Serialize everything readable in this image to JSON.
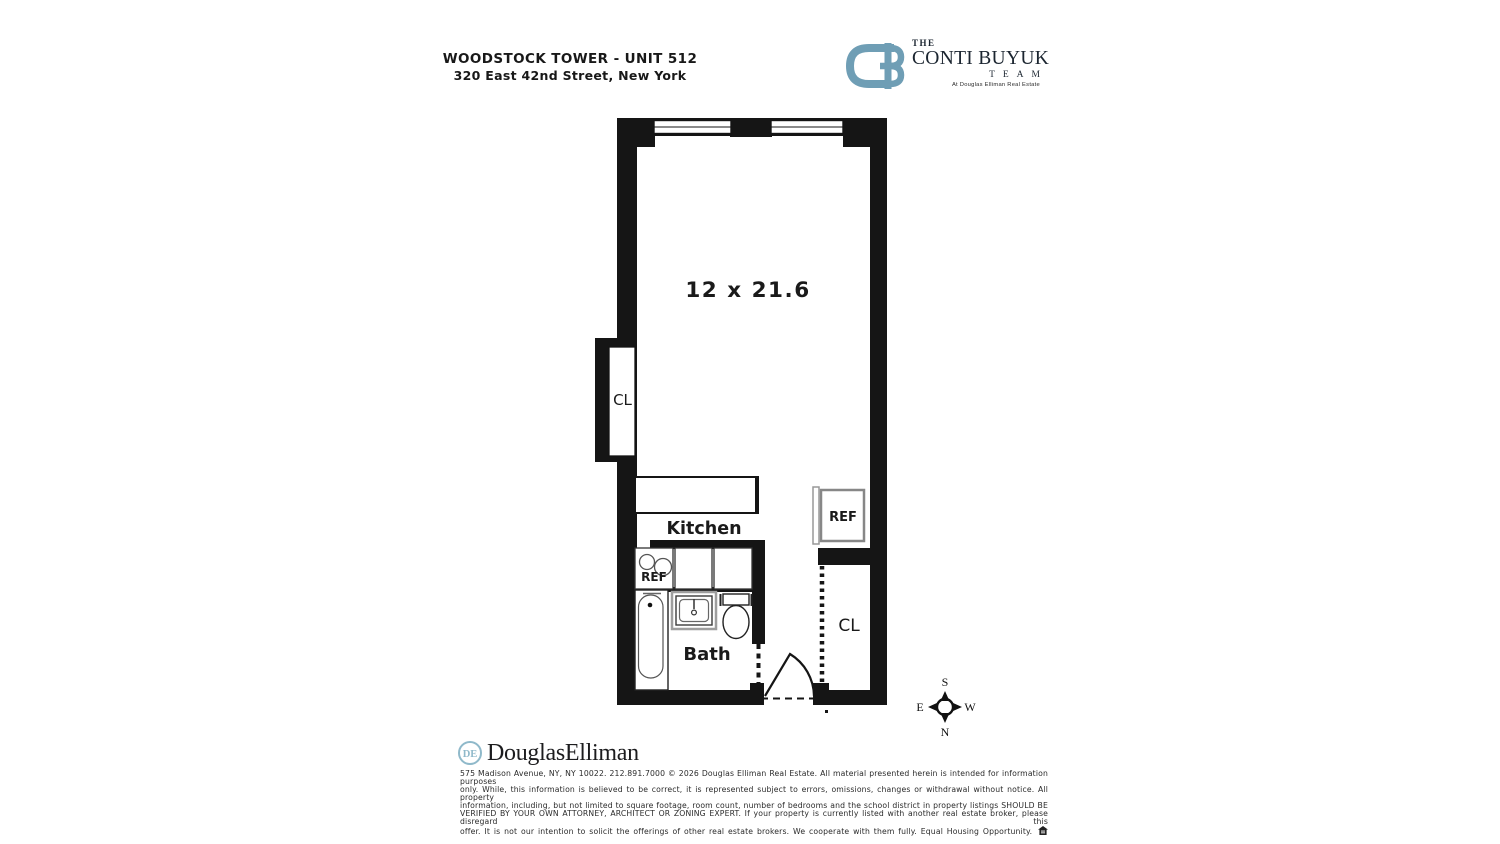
{
  "header": {
    "building": "WOODSTOCK TOWER - UNIT 512",
    "address": "320 East 42nd Street, New York"
  },
  "brand": {
    "monogram": "CB",
    "the": "THE",
    "name": "CONTI BUYUK",
    "team": "TEAM",
    "tagline": "At Douglas Elliman Real Estate",
    "accent_color": "#6f9eb5"
  },
  "floorplan": {
    "room_dimension": "12 x 21.6",
    "kitchen_label": "Kitchen",
    "bath_label": "Bath",
    "closet_left_label": "CL",
    "closet_right_label": "CL",
    "refrigerator_label": "REF",
    "kitchen_ref_label": "REF",
    "wall_color": "#151515"
  },
  "compass": {
    "top": "S",
    "bottom": "N",
    "left": "E",
    "right": "W"
  },
  "footer": {
    "logo_monogram": "DE",
    "logo_text": "DouglasElliman",
    "logo_accent_color": "#8fb9ca",
    "disclaimer_lines": [
      "575 Madison Avenue, NY, NY 10022. 212.891.7000 © 2026 Douglas Elliman Real Estate. All material presented herein is intended for information purposes",
      "only. While, this information is believed to be correct, it is represented subject to errors, omissions, changes or withdrawal without notice. All property",
      "information, including, but not limited to square footage, room count, number of bedrooms and the school district in property listings SHOULD BE",
      "VERIFIED BY YOUR OWN ATTORNEY, ARCHITECT OR ZONING EXPERT. If your property is currently listed with another real estate broker, please disregard this",
      "offer. It is not our intention to solicit the offerings of other real estate brokers. We cooperate with them fully. Equal Housing Opportunity."
    ]
  }
}
